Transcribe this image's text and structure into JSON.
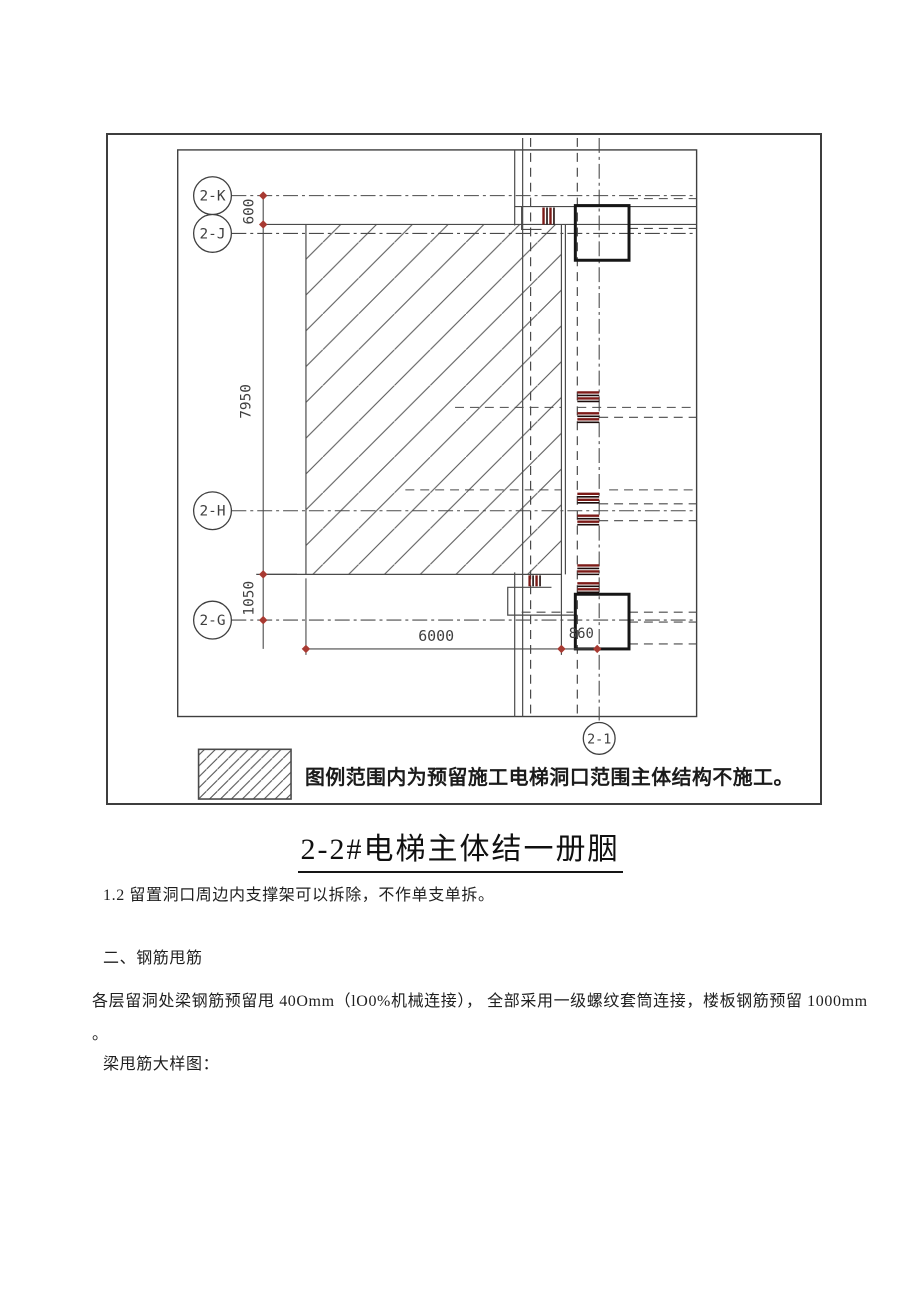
{
  "diagram": {
    "bubbles": {
      "k": "2-K",
      "j": "2-J",
      "h": "2-H",
      "g": "2-G",
      "v1": "2-1"
    },
    "dims": {
      "top": "600",
      "left": "7950",
      "left_lower": "1050",
      "bottom": "6000",
      "bottom_right": "860"
    },
    "legend_text": "图例范围内为预留施工电梯洞口范围主体结构不施工。",
    "colors": {
      "thin_line": "#4a4a4a",
      "heavy_line": "#161616",
      "rebar_red": "#7c1a17",
      "marker_red": "#a83a32"
    }
  },
  "title": {
    "text": "2-2#电梯主体结一册胭"
  },
  "notes": {
    "item": "1.2 留置洞口周边内支撑架可以拆除，不作单支单拆。",
    "heading": "二、钢筋甩筋",
    "body": "各层留洞处梁钢筋预留甩 40Omm（lO0%机械连接）， 全部采用一级螺纹套筒连接，楼板钢筋预留 1000mm",
    "body_period": "。",
    "caption": "梁甩筋大样图："
  }
}
